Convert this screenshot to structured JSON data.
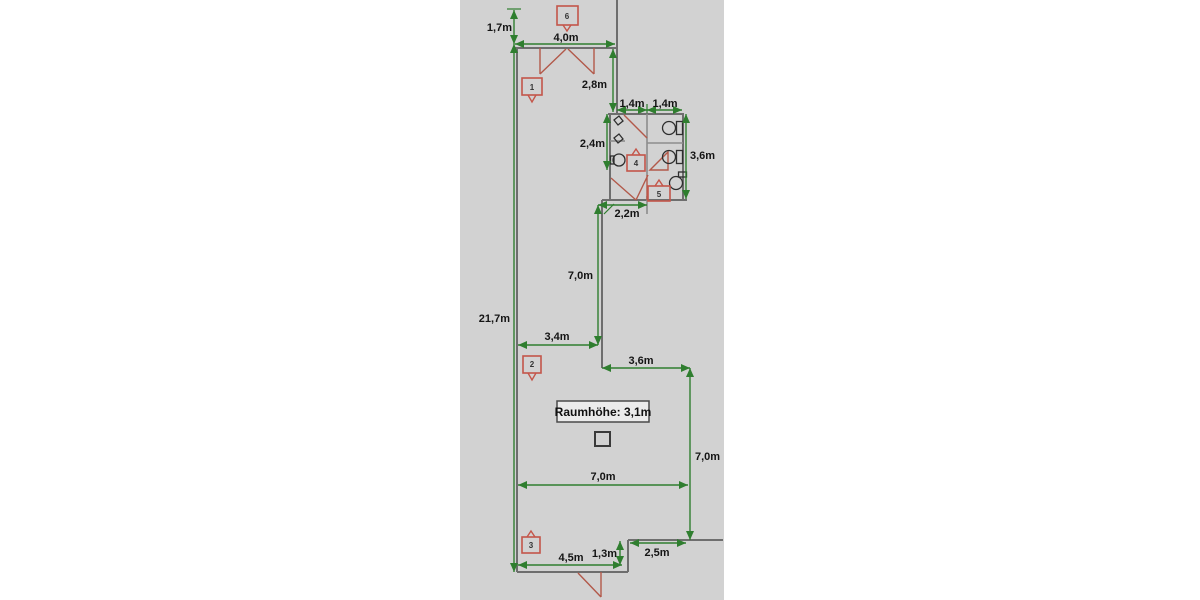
{
  "floorplan": {
    "room_height_note": "Raumhöhe: 3,1m",
    "room_markers": [
      "1",
      "2",
      "3",
      "4",
      "5",
      "6"
    ],
    "dimensions": {
      "entry_offset": "1,7m",
      "top_room_width": "4,0m",
      "top_room_depth": "2,8m",
      "wc_left_width": "1,4m",
      "wc_right_width": "1,4m",
      "wc_left_depth": "2,4m",
      "wc_right_depth": "3,6m",
      "passage_width": "2,2m",
      "corridor_length": "7,0m",
      "building_length": "21,7m",
      "corridor_width": "3,4m",
      "annex_width": "3,6m",
      "main_room_width": "7,0m",
      "main_room_depth": "7,0m",
      "bottom_wall_length": "4,5m",
      "recess_depth": "1,3m",
      "recess_width": "2,5m"
    },
    "colors": {
      "canvas": "#d2d2d2",
      "dimension_green": "#2f7e2f",
      "wall_gray": "#6e6e6e",
      "door_red": "#b2594a",
      "marker_red": "#c4564a"
    }
  }
}
